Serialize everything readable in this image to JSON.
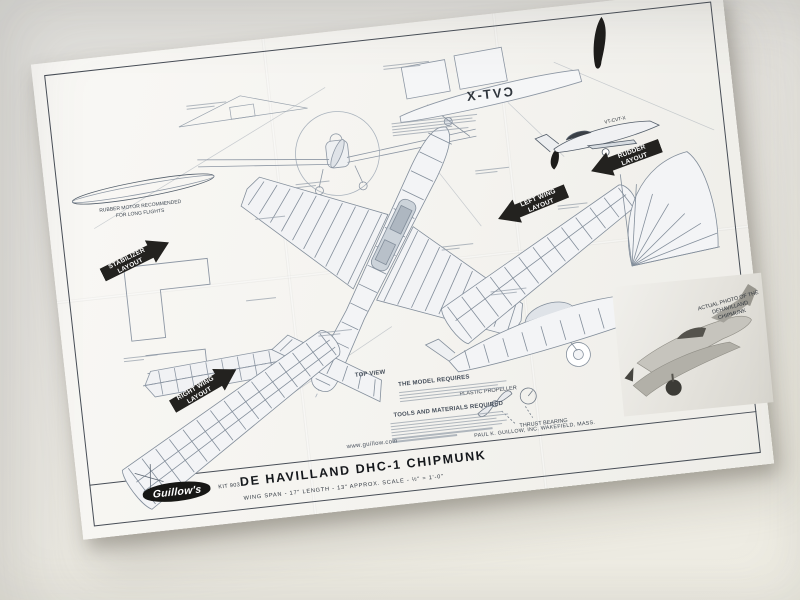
{
  "scene": {
    "background": "#e6e4df",
    "paper": "#f6f5f1",
    "ink_line": "#97a1ad",
    "ink_black": "#23221f"
  },
  "plan": {
    "arrows": {
      "stabilizer": {
        "line1": "STABILIZER",
        "line2": "LAYOUT"
      },
      "right_wing": {
        "line1": "RIGHT WING",
        "line2": "LAYOUT"
      },
      "left_wing": {
        "line1": "LEFT WING",
        "line2": "LAYOUT"
      },
      "rudder": {
        "line1": "RUDDER",
        "line2": "LAYOUT"
      }
    },
    "labels": {
      "rubber_motor_line1": "RUBBER MOTOR RECOMMENDED",
      "rubber_motor_line2": "FOR LONG FLIGHTS",
      "top_view": "TOP VIEW",
      "model_requires": "THE MODEL REQUIRES",
      "tools": "TOOLS AND MATERIALS REQUIRED",
      "plastic_propeller": "PLASTIC PROPELLER",
      "thrust_bearing": "THRUST BEARING",
      "registration_side_view": "VT-CVT-X",
      "registration_pattern_mirrored": "CVT-X",
      "photo_caption_line1": "ACTUAL PHOTO OF THE",
      "photo_caption_line2": "DEHAVILLAND CHIPMUNK",
      "copyright": "PAUL K. GUILLOW, INC.  WAKEFIELD, MASS."
    },
    "title_block": {
      "logo": "Guillow's",
      "kit_number": "KIT 903",
      "title": "DE HAVILLAND DHC-1 CHIPMUNK",
      "website": "www.guillow.com",
      "specs": "WING SPAN - 17\"      LENGTH - 13\"      APPROX. SCALE - ½\" = 1'-0\""
    }
  }
}
